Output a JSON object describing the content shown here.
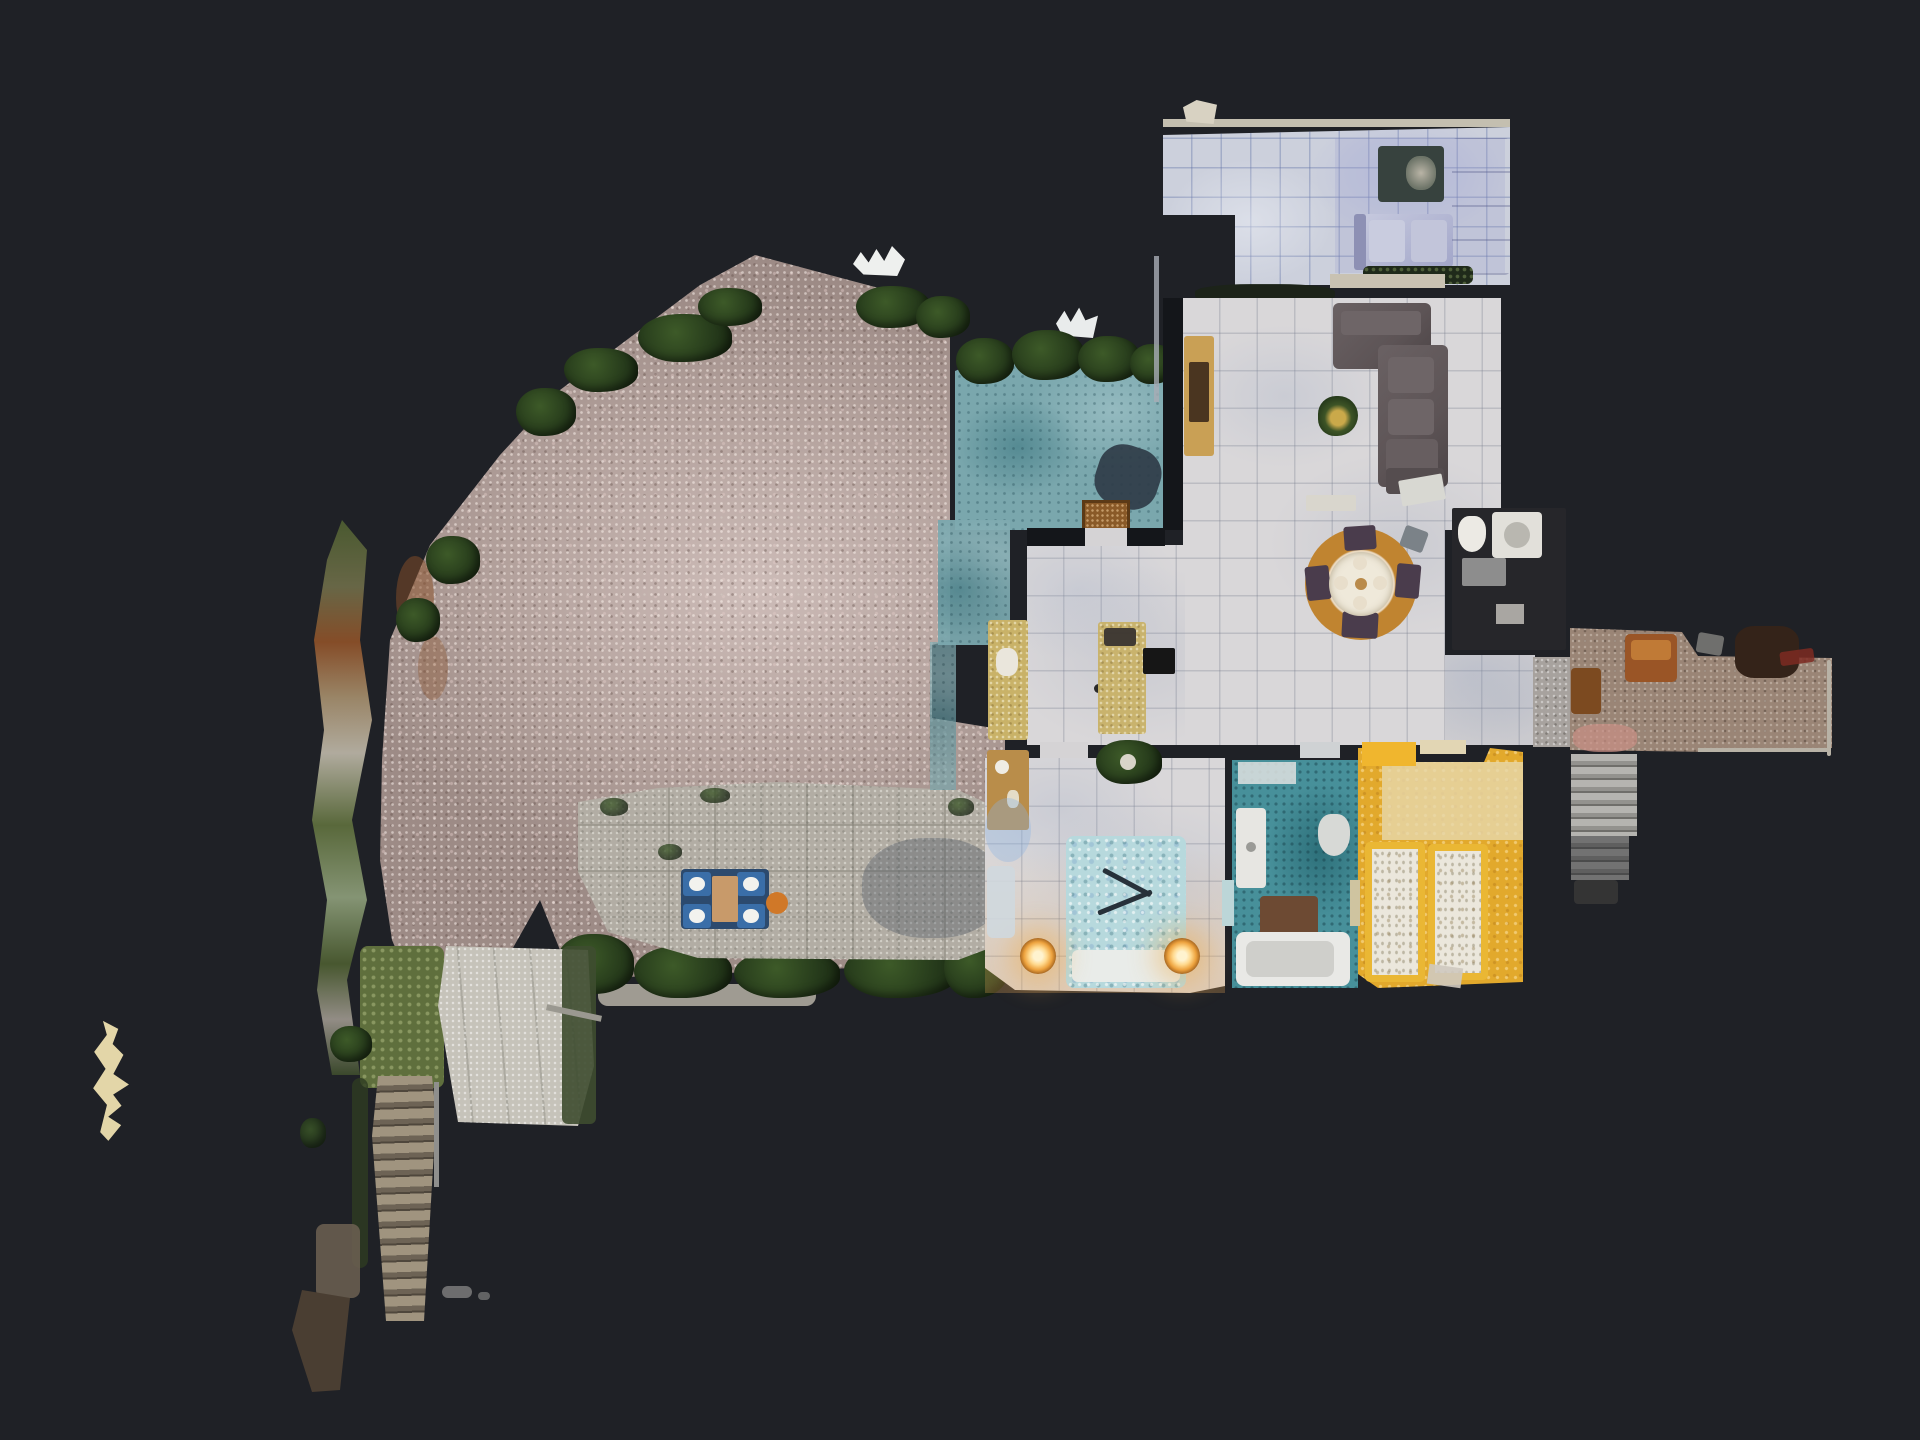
{
  "scene": {
    "title": "Top-down 3D dollhouse scan of an apartment with garden terrace",
    "view_mode": "dollhouse-top-down",
    "visible_text": "none"
  },
  "palette": {
    "background": "#1f2126",
    "tile_floor": "#d9d7d9",
    "tile_floor_cool": "#ccd0dc",
    "wall_dark": "#14161a",
    "wall_light": "#d6d0c0",
    "gravel_light": "#cdbcb8",
    "gravel_dark": "#9d8b86",
    "foliage": "#24381a",
    "foliage_dark": "#16240f",
    "terrace_teal": "#7aa7ad",
    "patio_stone": "#b2ada4",
    "sofa_charcoal": "#5d5456",
    "sofa_lavender": "#a2a6c9",
    "sofa_lavender_light": "#c6c9de",
    "coffee_table": "#37423e",
    "tv_console": "#c9a055",
    "rug_outer": "#c08430",
    "rug_inner": "#ead9c0",
    "chair_plum": "#4a3c4c",
    "kitchen_counter": "#c9b268",
    "stove": "#161616",
    "bed_duvet": "#b7d9dd",
    "lamp_glow": "#eda23e",
    "bath_teal": "#47909a",
    "tub_white": "#e9e9e6",
    "mat_brown": "#6d4a33",
    "yellow_floor": "#e2a92c",
    "yellow_bed_frame": "#eab734",
    "duvet_white": "#ebe7dc",
    "entry_carpet": "#9a8576",
    "entry_chair": "#9a5526",
    "entry_dark_furniture": "#342319",
    "step_light": "#b5b4b0",
    "step_dark": "#6f6e6a",
    "stairs_brown": "#a0947f",
    "path_concrete": "#c6c3ba",
    "path_green": "#5f6f3d",
    "door_white": "#d8d8d2",
    "doormat": "#8a5a28",
    "table_navy": "#2c4a6e",
    "chair_blue": "#3a6ea8",
    "accent_orange": "#d07828",
    "fragment_cream": "#e3d6a8",
    "pink_patch": "#c98f85"
  },
  "regions": [
    "upper-lounge",
    "living-room",
    "dining-area",
    "kitchen",
    "terrace",
    "upper-bathroom",
    "entry-hall",
    "interior-stairs",
    "master-bedroom",
    "family-bathroom",
    "twin-bedroom",
    "exterior-stairs",
    "gravel-yard",
    "stone-patio",
    "garden-hedge",
    "garden-path",
    "outdoor-staircase"
  ]
}
